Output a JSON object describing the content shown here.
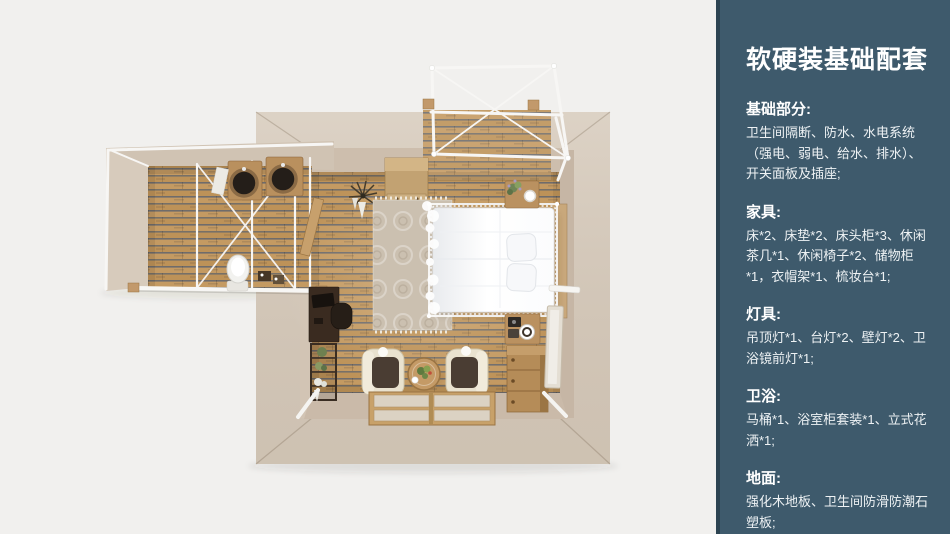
{
  "sidebar": {
    "title": "软硬装基础配套",
    "sections": [
      {
        "heading": "基础部分:",
        "body": "卫生间隔断、防水、水电系统（强电、弱电、给水、排水）、开关面板及插座;"
      },
      {
        "heading": "家具:",
        "body": "床*2、床垫*2、床头柜*3、休闲茶几*1、休闲椅子*2、储物柜*1，衣帽架*1、梳妆台*1;"
      },
      {
        "heading": "灯具:",
        "body": "吊顶灯*1、台灯*2、壁灯*2、卫浴镜前灯*1;"
      },
      {
        "heading": "卫浴:",
        "body": "马桶*1、浴室柜套装*1、立式花洒*1;"
      },
      {
        "heading": "地面:",
        "body": "强化木地板、卫生间防滑防潮石塑板;"
      }
    ]
  },
  "colors": {
    "canvas_bg": "#f1f0ee",
    "sidebar_bg": "#3e5a6c",
    "sidebar_edge": "#2c4351",
    "text_primary": "#ffffff",
    "text_body": "#eef2f4",
    "wall": "#d7cbbc",
    "wall_inner": "#c8b9a8",
    "floor_plank": "#c49a62",
    "floor_gap": "#60646c",
    "frame_white": "#f7f6f4",
    "furniture_wood": "#b58c58",
    "furniture_dark": "#3a2b20",
    "chair_cream": "#e9e2cf",
    "cushion_brown": "#4a3d33",
    "rug": "#cbc0b0"
  }
}
